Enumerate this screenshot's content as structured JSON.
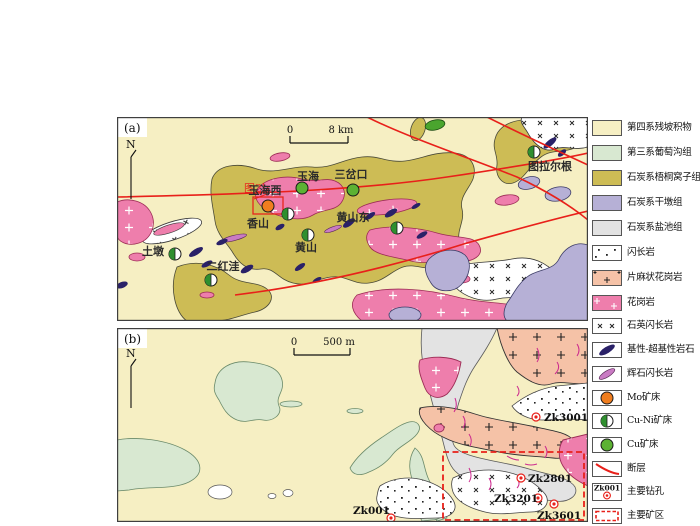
{
  "panel_a": {
    "label": "(a)",
    "north": "N",
    "scale_zero": "0",
    "scale_length": "8 km",
    "inset_ref": "图2b",
    "places": {
      "yuhaixi": "玉海西",
      "yuhai": "玉海",
      "sanchakou": "三岔口",
      "tulaergen": "图拉尔根",
      "xiangshan": "香山",
      "huangshandong": "黄山东",
      "huangshan": "黄山",
      "tudun": "土墩",
      "erhongwa": "二红洼"
    }
  },
  "panel_b": {
    "label": "(b)",
    "north": "N",
    "scale_zero": "0",
    "scale_length": "500 m",
    "drillholes": {
      "zk3001": "Zk3001",
      "zk2801": "Zk2801",
      "zk3201": "Zk3201",
      "zk3601": "Zk3601",
      "zk001": "Zk001"
    }
  },
  "legend": {
    "items": [
      {
        "id": "quaternary",
        "label": "第四系残坡积物",
        "color": "#f6efc3"
      },
      {
        "id": "tertiary-putaogou",
        "label": "第三系葡萄沟组",
        "color": "#d8e8d1"
      },
      {
        "id": "carboniferous-wutongwozi",
        "label": "石炭系梧桐窝子组",
        "color": "#cdbc55"
      },
      {
        "id": "carboniferous-gandun",
        "label": "石炭系干墩组",
        "color": "#b6b0d6"
      },
      {
        "id": "carboniferous-yanchi",
        "label": "石炭系盐池组",
        "color": "#e2e2e2"
      },
      {
        "id": "diorite",
        "label": "闪长岩",
        "color": "#ffffff"
      },
      {
        "id": "gneissic-granite",
        "label": "片麻状花岗岩",
        "color": "#f5c2a7"
      },
      {
        "id": "granite",
        "label": "花岗岩",
        "color": "#ee7eac"
      },
      {
        "id": "quartz-diorite",
        "label": "石英闪长岩",
        "color": "#ffffff"
      },
      {
        "id": "mafic-ultramafic",
        "label": "基性-超基性岩石",
        "color": "#2a2168"
      },
      {
        "id": "pyroxene-diorite",
        "label": "辉石闪长岩",
        "color": "#c97bc3"
      },
      {
        "id": "mo-deposit",
        "label": "Mo矿床",
        "color": "#f07d1e"
      },
      {
        "id": "cu-ni-deposit",
        "label": "Cu-Ni矿床",
        "color": "#2f8f2f"
      },
      {
        "id": "cu-deposit",
        "label": "Cu矿床",
        "color": "#5cb233"
      },
      {
        "id": "fault",
        "label": "断层",
        "color": "#e8201a"
      },
      {
        "id": "main-drillhole",
        "label": "主要钻孔",
        "symbol_text": "Zk001",
        "color": "#e8201a"
      },
      {
        "id": "main-mining-area",
        "label": "主要矿区",
        "color": "#e8201a"
      }
    ]
  }
}
